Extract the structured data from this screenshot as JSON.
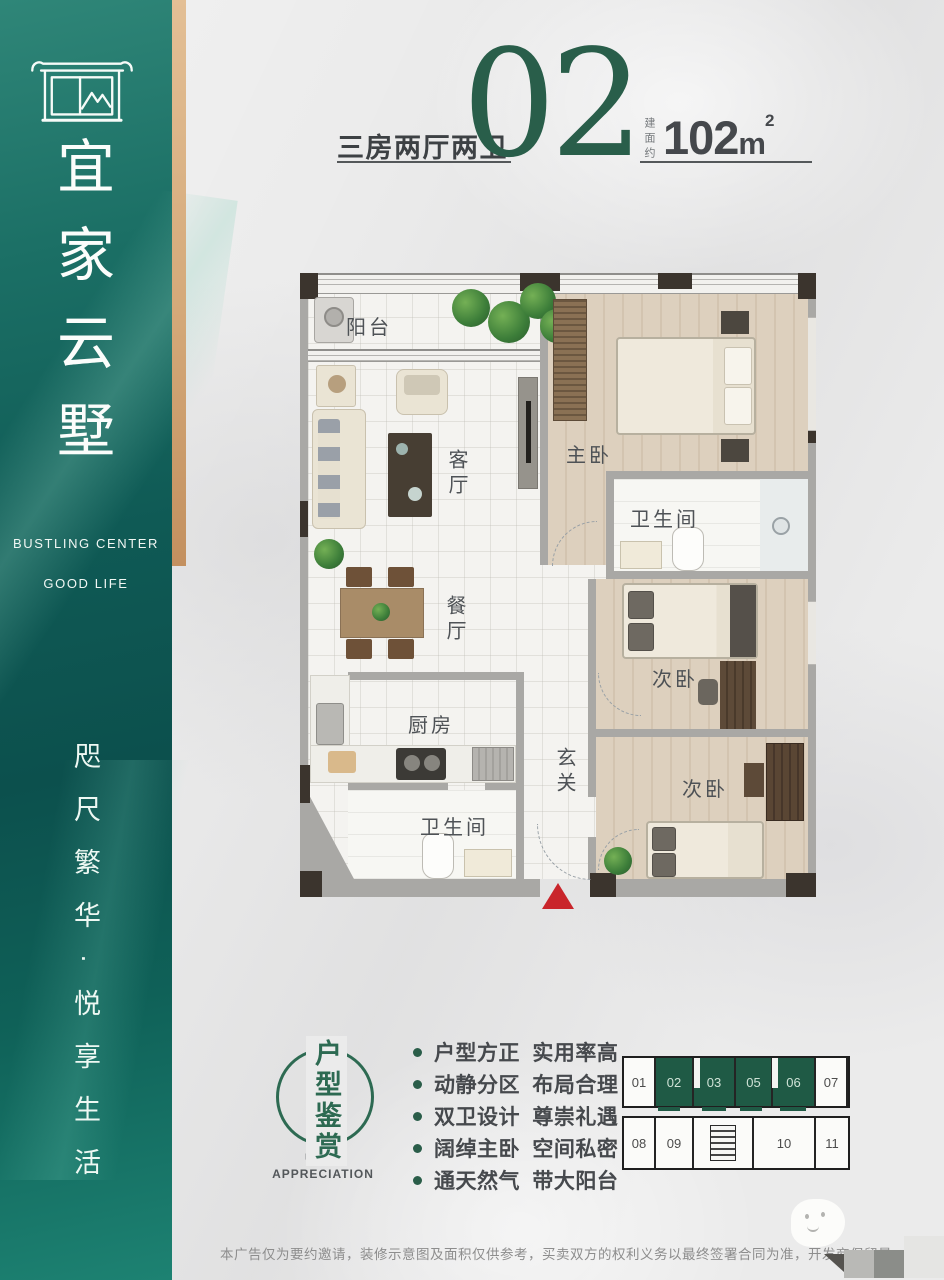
{
  "brand": {
    "logo_icon": "gate-pavilion",
    "name": "宜家云墅",
    "tagline_line1": "BUSTLING CENTER",
    "tagline_line2": "GOOD LIFE",
    "slogan": "咫尺繁华·悦享生活"
  },
  "header": {
    "type_label": "三房两厅两卫",
    "unit_number": "02",
    "area_prefix": "建面约",
    "area_value": "102",
    "area_unit": "m",
    "area_superscript": "2"
  },
  "floor_plan": {
    "rooms": [
      {
        "id": "balcony",
        "label": "阳台"
      },
      {
        "id": "master-bedroom",
        "label": "主卧"
      },
      {
        "id": "living-room",
        "label": "客厅"
      },
      {
        "id": "bathroom-master",
        "label": "卫生间"
      },
      {
        "id": "dining-room",
        "label": "餐厅"
      },
      {
        "id": "bedroom-2",
        "label": "次卧"
      },
      {
        "id": "kitchen",
        "label": "厨房"
      },
      {
        "id": "foyer",
        "label": "玄关"
      },
      {
        "id": "bathroom-common",
        "label": "卫生间"
      },
      {
        "id": "bedroom-3",
        "label": "次卧"
      }
    ],
    "entrance_marker_color": "#c9252b"
  },
  "stamp": {
    "title": "户型鉴赏",
    "subtitle_line1": "UNIT",
    "subtitle_line2": "APPRECIATION"
  },
  "features": [
    "户型方正 实用率高",
    "动静分区 布局合理",
    "双卫设计 尊崇礼遇",
    "阔绰主卧 空间私密",
    "通天然气 带大阳台"
  ],
  "unit_diagram": {
    "top_row": [
      {
        "num": "01",
        "highlight": false
      },
      {
        "num": "02",
        "highlight": true
      },
      {
        "num": "03",
        "highlight": true
      },
      {
        "num": "05",
        "highlight": true
      },
      {
        "num": "06",
        "highlight": true
      },
      {
        "num": "07",
        "highlight": false
      }
    ],
    "bottom_row": [
      {
        "num": "08",
        "highlight": false
      },
      {
        "num": "09",
        "highlight": false
      },
      {
        "num": "10",
        "highlight": false
      },
      {
        "num": "11",
        "highlight": false
      }
    ],
    "highlight_color": "#1f5a45"
  },
  "footer": {
    "disclaimer": "本广告仅为要约邀请，装修示意图及面积仅供参考，买卖双方的权利义务以最终签署合同为准，开发商保留最"
  },
  "colors": {
    "brand_green": "#295e4a",
    "sidebar_teal": "#0f5a55",
    "gold": "#d4a979",
    "accent_red": "#c9252b"
  }
}
